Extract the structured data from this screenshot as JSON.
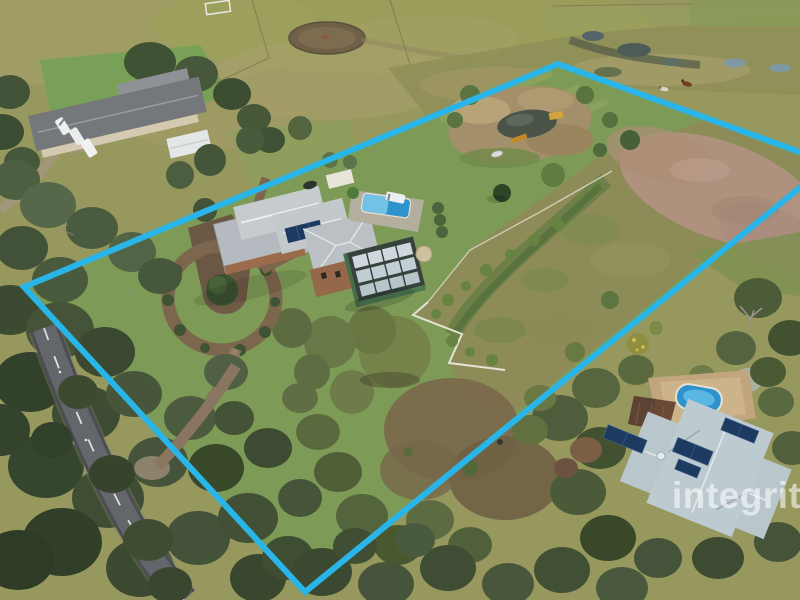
{
  "image": {
    "kind": "aerial drone photograph of rural acreage real-estate listing",
    "width_px": 800,
    "height_px": 600
  },
  "watermark": {
    "text": "integrity",
    "style": "semi-transparent white lowercase wordmark, bottom right, clipped by right edge of frame"
  },
  "boundary_overlay": {
    "shape": "quadrilateral property outline",
    "color": "#2ab5e9",
    "corners_visible": "left (~24,287), top (~558,64), bottom (~305,592); right corner extends past right edge"
  },
  "scene": {
    "features": [
      "main homestead with grey corrugated roofs, two-storey brick section and rooftop solar",
      "covered swimming pool beside homestead with white ute parked alongside",
      "green shed with rows of solar panels and cream water tank",
      "oval dirt loop driveway around central tree island with hedges",
      "landscaped dam with tan reeds, timber footbridge and white dinghy",
      "fenced rough-grass paddock on eastern half of property",
      "pink-brown scrub in north-east corner of block",
      "yellow-green pastures with round yard and white arena marking to the north",
      "wetland band with small ponds and two grazing horses, top right",
      "neighbouring long dark-roofed house with white vans and white shed, top left",
      "sealed road with dashed white centre line through dense bushland, lower left",
      "neighbouring pale-blue-roofed house with solar panels and kidney pool, lower right",
      "dense eucalyptus bushland across lower half of frame"
    ]
  },
  "colors": {
    "boundary_line": "#2ab5e9",
    "lawn_green": "#7d9a56",
    "pasture_olive": "#96985e",
    "scrub_pink": "#b29384",
    "bushland_dark": "#3a4930",
    "homestead_roof": "#c6cbcd",
    "se_house_roof": "#b9c6cc",
    "pool_blue": "#2e93cc",
    "solar_panel": "#1d3a60",
    "road_asphalt": "#63676c",
    "dirt_driveway": "#7c664e",
    "watermark_white": "#ffffff"
  }
}
